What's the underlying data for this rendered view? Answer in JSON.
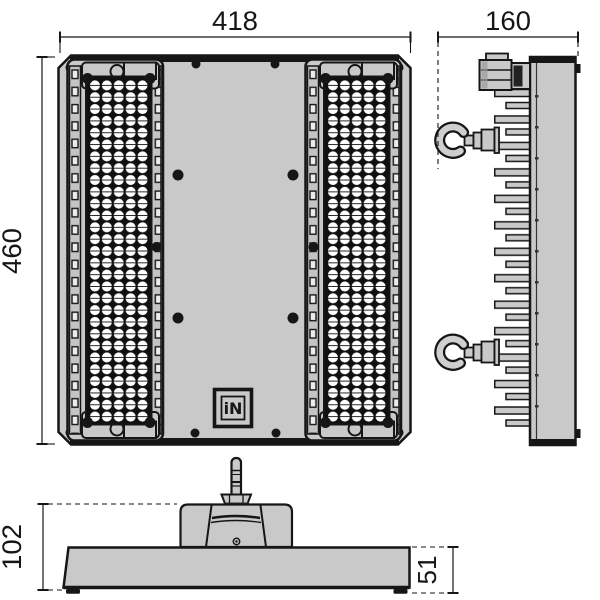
{
  "front_view": {
    "width_label": "418",
    "height_label": "460",
    "logo_text": "iN"
  },
  "side_view": {
    "depth_label": "160"
  },
  "bottom_view": {
    "total_height_label": "102",
    "housing_height_label": "51"
  },
  "colors": {
    "body_fill": "#c9c9c9",
    "outline": "#161616",
    "lens_fill": "#ffffff",
    "lens_background": "#101010",
    "background": "#ffffff"
  }
}
